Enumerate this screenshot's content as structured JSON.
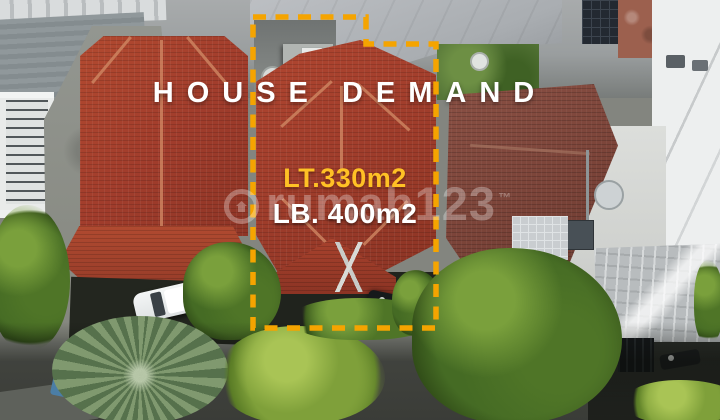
{
  "photo_overlay": {
    "title": "HOUSE DEMAND",
    "land_area": "LT.330m2",
    "building_area": "LB. 400m2"
  },
  "watermark": {
    "brand": "rumah123",
    "trademark": "™"
  },
  "colors": {
    "boundary_dash": "#F5A400",
    "title_text": "#FFFFFF",
    "land_area_text": "#FFC125",
    "building_area_text": "#FFFFFF"
  }
}
